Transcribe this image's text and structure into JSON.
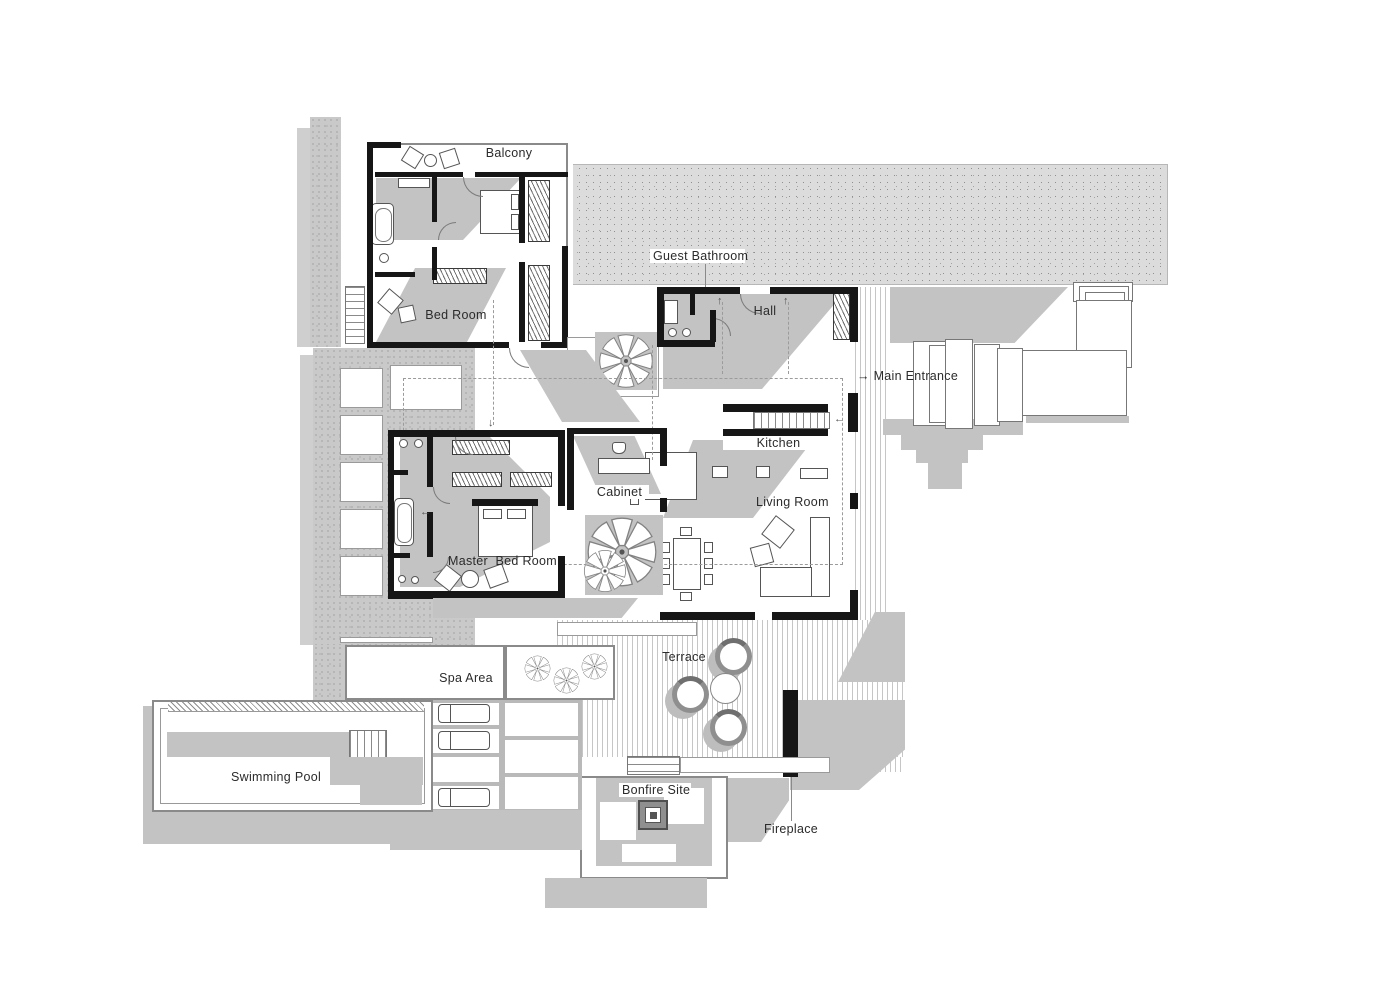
{
  "labels": {
    "balcony": "Balcony",
    "guest_bathroom": "Guest Bathroom",
    "hall": "Hall",
    "main_entrance_arrow": "→",
    "main_entrance": "Main Entrance",
    "bed_room": "Bed Room",
    "kitchen": "Kitchen",
    "cabinet": "Cabinet",
    "living_room": "Living Room",
    "master_bed_room": "Master  Bed Room",
    "spa_area": "Spa Area",
    "terrace": "Terrace",
    "swimming_pool": "Swimming Pool",
    "bonfire_site": "Bonfire Site",
    "fireplace": "Fireplace"
  },
  "colors": {
    "wall": "#161616",
    "shadow": "#c3c3c3",
    "roof_stipple": "#dcdcdc",
    "strip_stipple": "#c9c9c9",
    "deck_stripe": "#c6c6c6",
    "water": "#c3c3c3",
    "outline": "#777777",
    "label_text": "#2b2b2b"
  }
}
